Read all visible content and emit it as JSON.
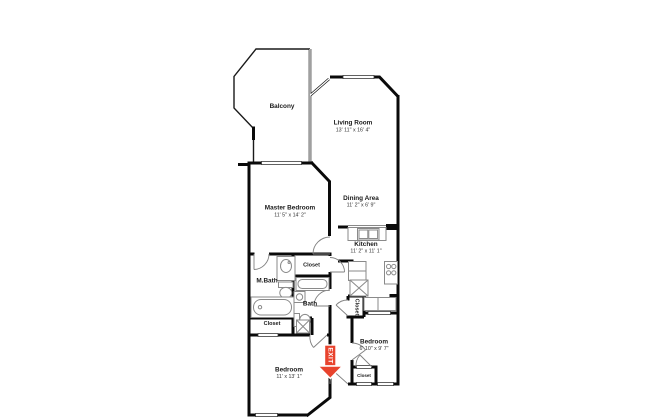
{
  "floorplan": {
    "background": "#ffffff",
    "wall_color": "#0a0a0a",
    "fixture_color": "#8a8a8a",
    "exit": {
      "label": "EXIT",
      "color": "#e8432d"
    },
    "rooms": {
      "balcony": {
        "name": "Balcony"
      },
      "living_room": {
        "name": "Living Room",
        "dims": "13' 11\" x 16' 4\""
      },
      "master_bedroom": {
        "name": "Master Bedroom",
        "dims": "11' 5\" x 14' 2\""
      },
      "dining_area": {
        "name": "Dining Area",
        "dims": "11' 2\" x 6' 9\""
      },
      "kitchen": {
        "name": "Kitchen",
        "dims": "11' 2\" x 11' 1\""
      },
      "master_bath": {
        "name": "M.Bath"
      },
      "bath": {
        "name": "Bath"
      },
      "bedroom_large": {
        "name": "Bedroom",
        "dims": "11' x 13' 1\""
      },
      "bedroom_small": {
        "name": "Bedroom",
        "dims": "6' 10\" x 9' 7\""
      },
      "closet_hall": {
        "name": "Closet"
      },
      "closet_mbath": {
        "name": "Closet"
      },
      "closet_kitchen": {
        "name": "Closet"
      },
      "closet_bedroom_small": {
        "name": "Closet"
      }
    }
  }
}
